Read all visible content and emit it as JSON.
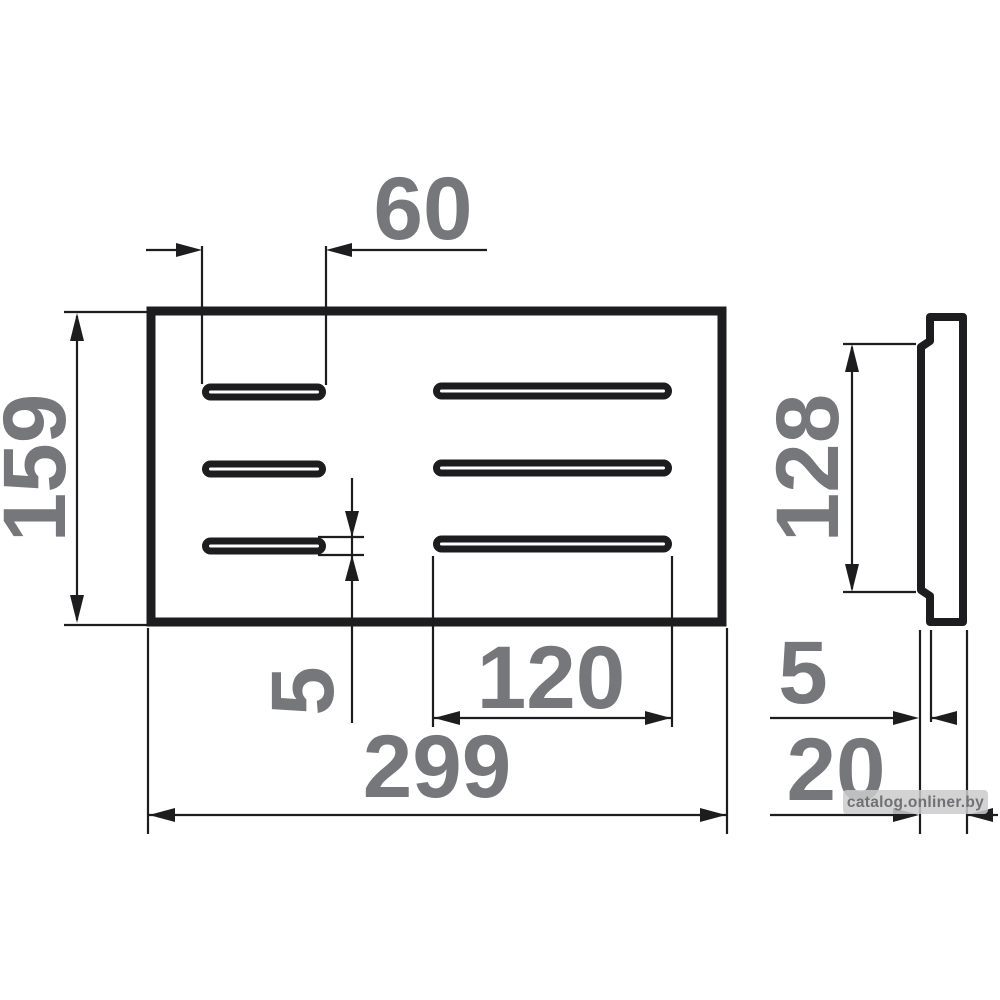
{
  "drawing": {
    "type": "technical-dimension-drawing",
    "views": {
      "front": "slotted plate with 6 drain slots (2 columns x 3 rows)",
      "side": "thin profile with protruding middle lip"
    },
    "dimensions": {
      "slot_length_short": "60",
      "height_overall": "159",
      "slot_height": "5",
      "slot_length_long": "120",
      "width_overall": "299",
      "side_recess_height": "128",
      "side_lip_thickness": "5",
      "side_depth_overall": "20"
    },
    "watermark": {
      "text": "catalog.onliner.by"
    },
    "colors": {
      "background": "#ffffff",
      "line": "#1d1d1f",
      "dimension_text": "#76777a",
      "watermark_bg": "#cbcbcb",
      "watermark_text": "#6f7174"
    }
  }
}
